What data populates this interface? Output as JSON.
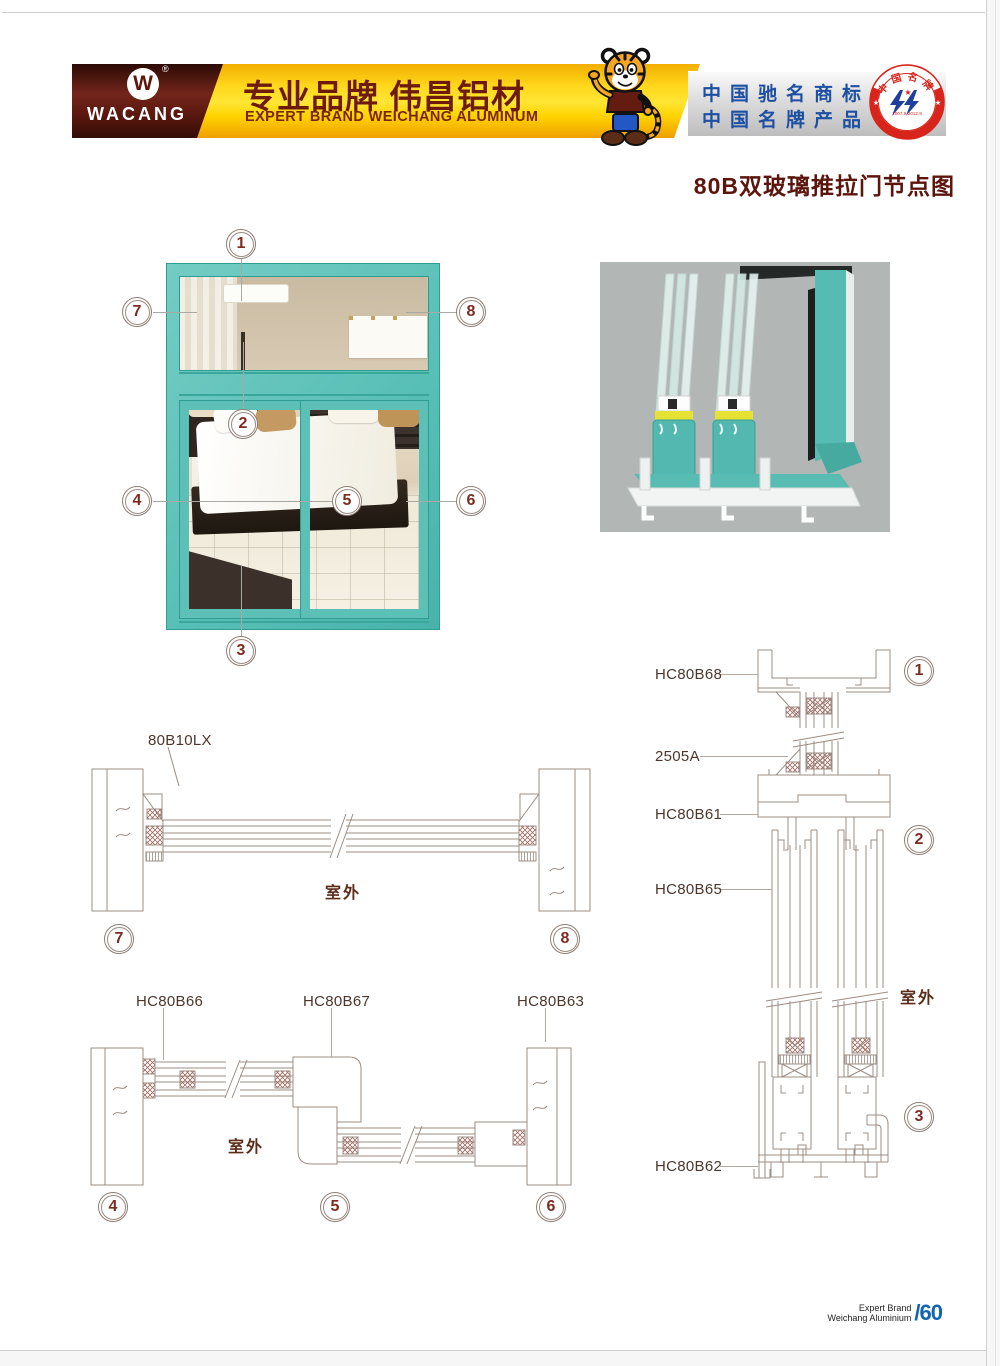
{
  "header": {
    "logo_text": "WACANG",
    "registered_mark": "®",
    "banner_title_cn": "专业品牌  伟昌铝材",
    "banner_subtitle_en": "EXPERT BRAND WEICHANG ALUMINUM",
    "honor_line1": "中国驰名商标",
    "honor_line2": "中国名牌产品",
    "badge": {
      "arc_top": "中国名牌",
      "arc_bottom": "CHINA TOP BRAND",
      "dates": "2007.9-2012.9"
    }
  },
  "page_title": "80B双玻璃推拉门节点图",
  "diagram": {
    "outdoor_label": "室外",
    "profiles": {
      "p80b10lx": "80B10LX",
      "hc80b66": "HC80B66",
      "hc80b67": "HC80B67",
      "hc80b63": "HC80B63",
      "hc80b68": "HC80B68",
      "a2505": "2505A",
      "hc80b61": "HC80B61",
      "hc80b65": "HC80B65",
      "hc80b62": "HC80B62"
    },
    "callouts": {
      "c1": "1",
      "c2": "2",
      "c3": "3",
      "c4": "4",
      "c5": "5",
      "c6": "6",
      "c7": "7",
      "c8": "8"
    }
  },
  "footer": {
    "brand_line1": "Expert Brand",
    "brand_line2": "Weichang Aluminium",
    "page_number": "/60"
  },
  "colors": {
    "teal": "#5fc2b9",
    "banner_yellow": "#ffd400",
    "maroon_text": "#5b150c",
    "honor_blue": "#1d4fa3",
    "badge_red": "#d8251c",
    "cad_line": "#9c8c83",
    "footer_blue": "#1064b0"
  }
}
